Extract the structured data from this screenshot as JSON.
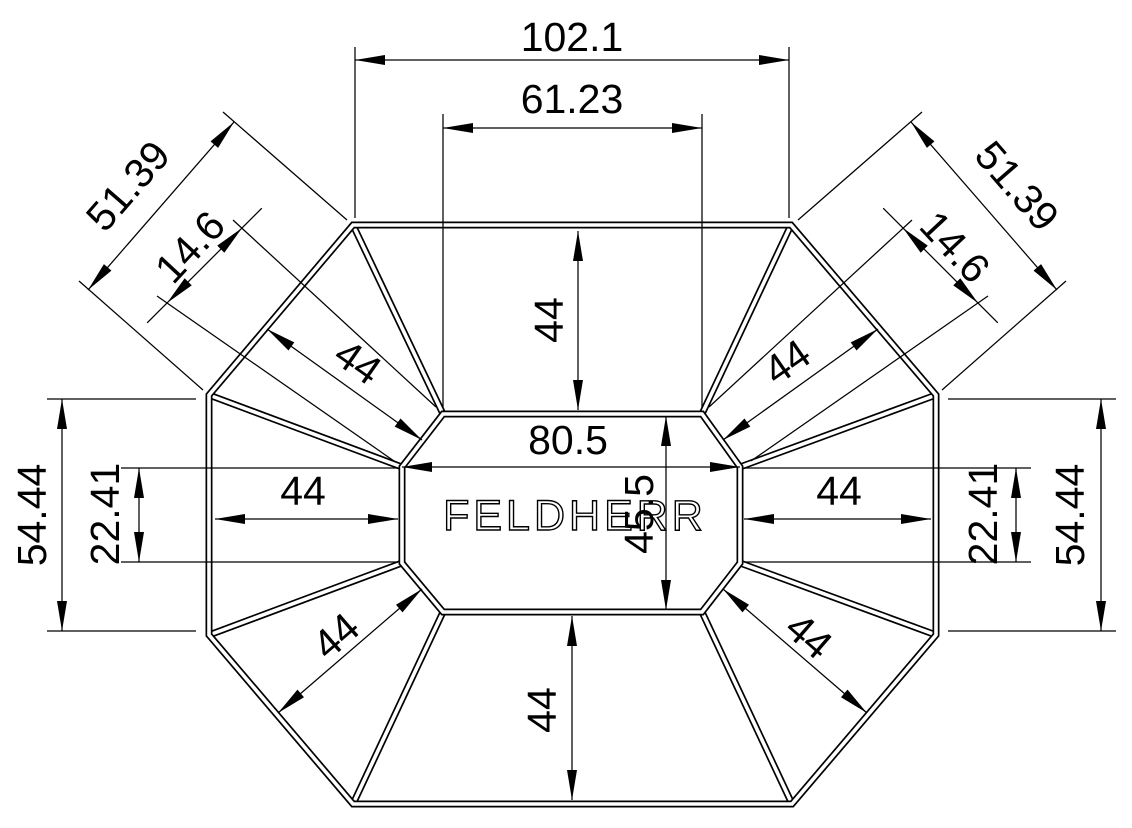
{
  "drawing": {
    "center_label": "FELDHERR",
    "colors": {
      "line": "#000000",
      "background": "#ffffff"
    },
    "dimensions": {
      "top_width": "102.1",
      "inner_top_width": "61.23",
      "diagonal_top_left": "51.39",
      "diagonal_top_right": "51.39",
      "inner_corner_top_left": "14.6",
      "inner_corner_top_right": "14.6",
      "depth_top": "44",
      "depth_bottom": "44",
      "depth_left": "44",
      "depth_right": "44",
      "depth_top_left": "44",
      "depth_top_right": "44",
      "depth_bottom_left": "44",
      "depth_bottom_right": "44",
      "inner_width": "80.5",
      "inner_height": "45.5",
      "outer_side_left": "54.44",
      "outer_side_right": "54.44",
      "inner_side_left": "22.41",
      "inner_side_right": "22.41"
    }
  }
}
